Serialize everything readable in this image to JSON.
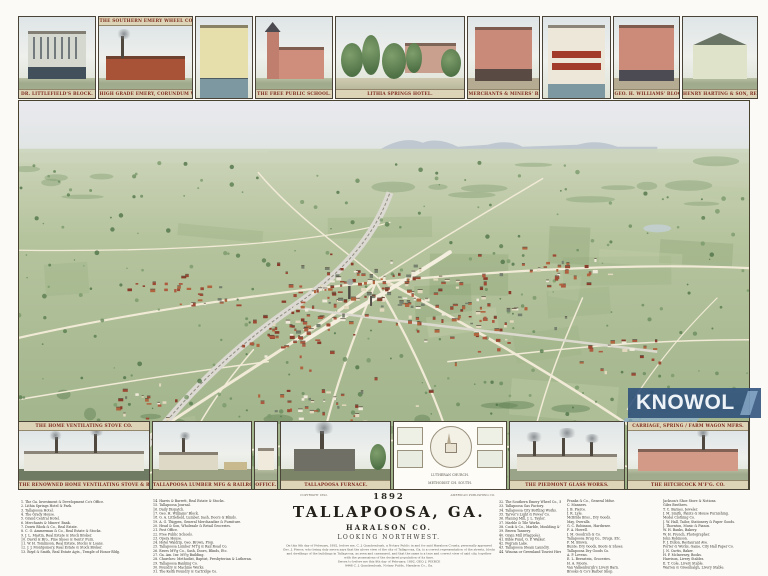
{
  "sheet": {
    "year": "1892",
    "title": "TALLAPOOSA, GA.",
    "county": "HARALSON CO.",
    "orientation": "LOOKING NORTHWEST.",
    "credit_left": "COPYRIGHT 1892.",
    "credit_right": "AMERICAN PUBLISHING CO."
  },
  "watermark": {
    "text": "KNOWOL",
    "bg": "#2d507c",
    "fg": "#eef3f8"
  },
  "top_vignettes": [
    {
      "caption": "DR. LITTLEFIELD'S BLOCK."
    },
    {
      "header": "THE SOUTHERN EMERY WHEEL CO.",
      "caption": "HIGH GRADE EMERY, CORUNDUM WHEEL, MFRS."
    },
    {
      "caption": ""
    },
    {
      "caption": "THE FREE PUBLIC SCHOOL."
    },
    {
      "caption": "LITHIA SPRINGS HOTEL."
    },
    {
      "caption": "MERCHANTS & MINERS' BANK."
    },
    {
      "caption": ""
    },
    {
      "caption": "GEO. H. WILLIAMS' BLOCK."
    },
    {
      "caption": "HENRY HARTING & SON, REAL ESTATE."
    }
  ],
  "bottom_vignettes": [
    {
      "header": "THE HOME VENTILATING STOVE CO.",
      "caption": "THE RENOWNED HOME VENTILATING STOVE & RANGE MFRS."
    },
    {
      "caption": "TALLAPOOSA LUMBER MFG & RAILROAD CO."
    },
    {
      "caption": "OFFICE."
    },
    {
      "caption": "TALLAPOOSA FURNACE."
    },
    {
      "caption": "LUTHERAN CHURCH.",
      "caption2": "METHODIST CH. SOUTH."
    },
    {
      "caption": "THE PIEDMONT GLASS WORKS."
    },
    {
      "header": "CARRIAGE, SPRING / FARM WAGON MFRS.",
      "caption": "THE HITCHCOCK M'F'G. CO."
    }
  ],
  "directory": {
    "col1": [
      "1. The Ga. Investment & Development Co's Office.",
      "2. Lithia Springs Hotel & Park.",
      "3. Tallapoosa Hotel.",
      "4. The Grady House.",
      "5. Grand Central Hotel.",
      "6. Merchants & Miners' Bank.",
      "7. Dowis Block & Co., Real Estate.",
      "8. C. O. Ammerman & Co., Real Estate & Stocks.",
      "9. J. L. Mastin, Real Estate & Stock Broker.",
      "10. David & Bro., Fine Shoes & Gents' Furn.",
      "11. W. H. Tomlinson, Real Estate, Stocks & Loans.",
      "12. J. J. Montgomery, Real Estate & Stock Broker.",
      "13. Boyd & Smith, Real Estate Agts., Temple of Honor Bldg."
    ],
    "col2": [
      "14. Harris & Barrett, Real Estate & Stocks.",
      "15. Tallapoosa Journal.",
      "16. Daily Dispatch.",
      "17. Geo. H. Williams' Block.",
      "18. G. A. Littlefield, Lumber, Sash, Doors & Blinds.",
      "19. A. G. Thigpen, General Merchandise & Furniture.",
      "20. Head & Son, Wholesale & Retail Groceries.",
      "21. Post Office.",
      "22. Free Public Schools.",
      "23. Opera House.",
      "24. Hotel Waldrip, Geo. Brown, Prop.",
      "25. Tallapoosa Lumber M'f'g & Rail Road Co.",
      "26. Eaves M'f'g Co., Sash, Doors, Blinds, Etc.",
      "27. Ga. Am. Inv. M'f'g Building.",
      "28. Churches: Methodist, Baptist, Presbyterian & Lutheran.",
      "29. Tallapoosa Banking Co.",
      "30. Foundry & Machine Works.",
      "31. The Keith Foundry & Cartridge Co."
    ],
    "col3": [
      "32. The Southern Emery Wheel Co., Emery & Corundum Wheels.",
      "33. Tallapoosa Gas Factory.",
      "34. Tallapoosa City Bottling Works.",
      "35. Tarver's Light & Power Co.",
      "36. Planing Mill, J. L. Taylor.",
      "37. Marble & Tile Works.",
      "38. Cook & Co., Marble, Moulding & Wood Turning Mills.",
      "39. Brown Tannery.",
      "40. Grain Mill (Flagpole).",
      "41. Bible Fund, G. P. Walker.",
      "42. Pegram Lake.",
      "43. Tallapoosa Steam Laundry.",
      "44. Winona or Greenland Tourist Hive."
    ],
    "col4": [
      "Franks & Co., General Mdse.",
      "C. Manners.",
      "J. B. Pierce.",
      "J. R. Lyle.",
      "McBride Bros., Dry Goods.",
      "May, Overalls.",
      "G. C. Robinson, Hardware.",
      "F. A. Howell.",
      "J. M. Goodrich & Co.",
      "Tallapoosa Drug Co., Drugs, Etc.",
      "F. M. Brown.",
      "Bunte: Dry Goods, Boots & Shoes.",
      "Tallapoosa Dry Goods Co.",
      "A. P. Levens.",
      "E. L. Bernstein, Groceries.",
      "H. A. Moore.",
      "Van Valkenburgh's Livery Barn.",
      "Brooks & Co's Barber Shop."
    ],
    "col5": [
      "Jackson's Shoe Store & Notions.",
      "Giles Brothers.",
      "T. C. Barnes, Jeweler.",
      "J. M. Smith, Paints & House Furnishing.",
      "Model Clothing Co.",
      "J. W. Hall, Tailor, Stationery & Paper Goods.",
      "J. Thornton, Music & Pianos.",
      "W. H. Banks, Bakery.",
      "W. H. French, Photographer.",
      "John Robinson.",
      "F. J. Dillon, Restaurant Ave.",
      "Porter & Works, Game, City Hall Paper Co.",
      "J. N. Curtis, Baker.",
      "H. P. McInerney, Books.",
      "Harrison, Livery Stables.",
      "E. T. Cole, Livery Stable.",
      "Warren & Greenhalgh, Livery Stable."
    ]
  },
  "fine_print": {
    "lines": [
      "On this 9th day of February, 1892, before me, C. J. Quackenbush, a Notary Public in and for said Haralson County, personally appeared",
      "Geo. J. Pierce, who being duly sworn says that the above view of the city of Tallapoosa, Ga. is a correct representation of the streets, blocks",
      "and dwellings of the buildings in Tallapoosa, as seen and canvassed, and that the same is a true and correct view of said city, together",
      "with the possessions of the declared population of its time.",
      "Sworn to before me this 9th day of February, 1892.        GEO. J. PIERCE",
      "9448        C. J. Quackenbush, Notary Public, Haralson Co., Ga."
    ]
  },
  "colors": {
    "caption_text": "#7d2c1e",
    "caption_band": "#ddd3b6",
    "sky": "#e7e9ec",
    "land_light": "#d9ddc9",
    "land_dark": "#9cb086",
    "road": "#f1ead6",
    "watermark_bg": "#2d507c"
  }
}
